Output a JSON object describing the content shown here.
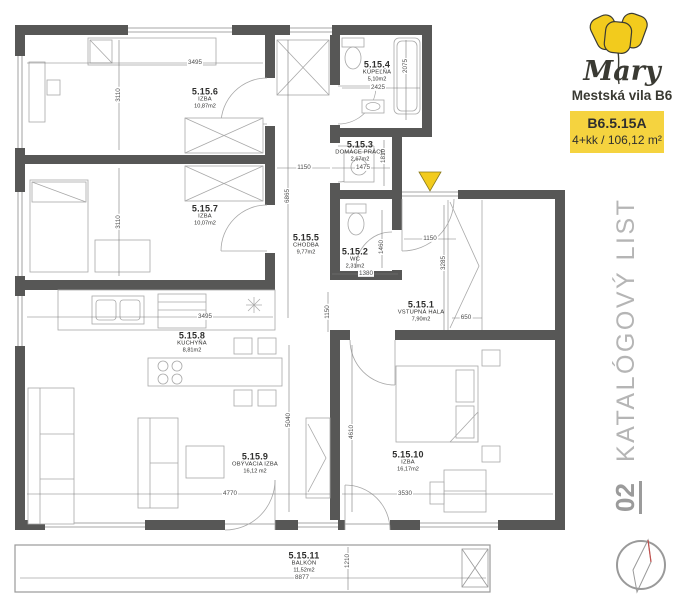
{
  "brand": {
    "name": "Mary",
    "subtitle": "Mestská vila B6"
  },
  "unit": {
    "code": "B6.5.15A",
    "spec": "4+kk / 106,12 m²"
  },
  "doc": {
    "number": "02",
    "type_label": "KATALÓGOVÝ LIST"
  },
  "colors": {
    "accent_yellow": "#F2CB1D",
    "badge_yellow": "#F5D33F",
    "wall_gray": "#575756",
    "text_dark": "#2F2F2E",
    "muted_gray": "#B5B5B5",
    "compass_red": "#C0504D"
  },
  "icons": {
    "tulip_logo": "yellow-tulip",
    "entrance_marker": "yellow-triangle-down",
    "compass": "north-needle"
  },
  "rooms": [
    {
      "number": "5.15.1",
      "name": "VSTUPNÁ HALA",
      "area": "7,90m2"
    },
    {
      "number": "5.15.2",
      "name": "WC",
      "area": "2,31m2"
    },
    {
      "number": "5.15.3",
      "name": "DOMÁCE PRÁCE",
      "area": "2,67m2"
    },
    {
      "number": "5.15.4",
      "name": "KÚPEĽŇA",
      "area": "5,10m2"
    },
    {
      "number": "5.15.5",
      "name": "CHODBA",
      "area": "9,77m2"
    },
    {
      "number": "5.15.6",
      "name": "IZBA",
      "area": "10,87m2"
    },
    {
      "number": "5.15.7",
      "name": "IZBA",
      "area": "10,07m2"
    },
    {
      "number": "5.15.8",
      "name": "KUCHYŇA",
      "area": "8,81m2"
    },
    {
      "number": "5.15.9",
      "name": "OBÝVACIA IZBA",
      "area": "16,12 m2"
    },
    {
      "number": "5.15.10",
      "name": "IZBA",
      "area": "16,17m2"
    },
    {
      "number": "5.15.11",
      "name": "BALKÓN",
      "area": "11,52m2"
    }
  ],
  "dims": [
    {
      "value": "3495"
    },
    {
      "value": "3110"
    },
    {
      "value": "3110"
    },
    {
      "value": "2425"
    },
    {
      "value": "2075"
    },
    {
      "value": "1475"
    },
    {
      "value": "1810"
    },
    {
      "value": "1150"
    },
    {
      "value": "6865"
    },
    {
      "value": "1460"
    },
    {
      "value": "1380"
    },
    {
      "value": "1150"
    },
    {
      "value": "1150"
    },
    {
      "value": "3285"
    },
    {
      "value": "650"
    },
    {
      "value": "3495"
    },
    {
      "value": "5040"
    },
    {
      "value": "4610"
    },
    {
      "value": "4770"
    },
    {
      "value": "3530"
    },
    {
      "value": "8877"
    },
    {
      "value": "1210"
    }
  ]
}
